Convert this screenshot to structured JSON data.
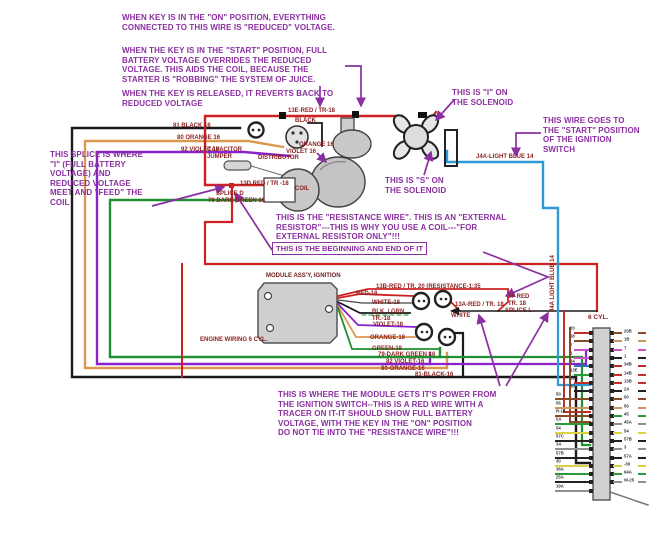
{
  "annotations": {
    "key_on": [
      "WHEN KEY IS IN THE \"ON\" POSITION, EVERYTHING",
      "CONNECTED TO THIS WIRE IS \"REDUCED\" VOLTAGE."
    ],
    "key_start": [
      "WHEN THE KEY IS IN THE \"START\" POSITION, FULL",
      "BATTERY VOLTAGE OVERRIDES THE REDUCED",
      "VOLTAGE. THIS AIDS THE COIL, BECAUSE THE",
      "STARTER IS \"ROBBING\" THE SYSTEM OF JUICE."
    ],
    "key_released": [
      "WHEN THE KEY IS RELEASED, IT REVERTS BACK TO",
      "REDUCED VOLTAGE"
    ],
    "splice_note": [
      "THIS SPLICE IS WHERE",
      "\"I\" (FULL BATTERY",
      "VOLTAGE) AND",
      "REDUCED VOLTAGE",
      "MEET AND \"FEED\" THE",
      "COIL"
    ],
    "i_solenoid": [
      "THIS IS \"I\" ON",
      "THE SOLENOID"
    ],
    "start_wire": [
      "THIS WIRE GOES TO",
      "THE \"START\" POSIITION",
      "OF THE IGNITION",
      "SWITCH"
    ],
    "s_solenoid": [
      "THIS IS \"S\" ON",
      "THE SOLENOID"
    ],
    "resistance_note": [
      "THIS IS THE \"RESISTANCE WIRE\". THIS IS AN \"EXTERNAL",
      "RESISTOR\"---THIS IS WHY YOU USE A COIL---\"FOR",
      "EXTERNAL RESISTOR ONLY\"!!!"
    ],
    "begin_end": "THIS IS THE BEGINNING AND END OF IT",
    "module_power_note": [
      "THIS IS WHERE THE MODULE GETS IT'S POWER FROM",
      "THE IGNITION SWITCH--THIS IS A RED WIRE WITH A",
      "TRACER ON IT-IT SHOULD SHOW FULL BATTERY",
      "VOLTAGE, WITH THE KEY IN THE \"ON\" POSITION",
      "DO NOT TIE INTO THE \"RESISTANCE WIRE\"!!!"
    ]
  },
  "wire_labels": {
    "w81": "81 BLACK 16",
    "w80": "80 ORANGE 16",
    "w92": "92 VIOLET 16",
    "capacitor": [
      "CAPACITOR",
      "JUMPER"
    ],
    "w13d": "13D RED / TR -18",
    "splice_d": "SPLICE D",
    "w79": "79 DARK GREEN 16",
    "w13e": "13E-RED / TR-18",
    "black": "BLACK",
    "orange16": "ORANGE 16",
    "violet16": "VIOLET 16",
    "distributor": "DISTRIBUTOR",
    "coil": "COIL",
    "j4a": "J4A-LIGHT BLUE 14",
    "j4a_vertical": "J4A LIGHT BLUE 14",
    "module": "MODULE ASS'Y, IGNITION",
    "engine": "ENGINE WIRING 6 CYL.",
    "w13b": "13B-RED / TR. 20 (RESISTANCE-1:35",
    "red18": "RED-18",
    "white18": "WHITE-18",
    "blkgrn": [
      "BLK. / GRN",
      "TR.-18"
    ],
    "violet18": "VIOLET-18",
    "orange18": "ORANGE-18",
    "green18": "GREEN-18",
    "w79b": "79-DARK GREEN 16",
    "w82b": "82 VIOLET-16",
    "w80b": "80-ORANGE-16",
    "w81b": "81-BLACK-16",
    "w13a": "13A-RED / TR. 18",
    "white": "WHITE",
    "w3f": [
      "3F RED",
      "TR. 18"
    ],
    "splice_l": "SPLICE L"
  },
  "connector": {
    "title": "6 CYL.",
    "rows": [
      {
        "l": "20",
        "r": "20B",
        "lc": "#c03028",
        "rc": "#8a4a28"
      },
      {
        "l": "18",
        "r": "1B",
        "lc": "#8a4a28",
        "rc": "#c89a62"
      },
      {
        "l": "7",
        "r": "7",
        "lc": "#d050c8",
        "rc": "#d050c8"
      },
      {
        "l": "1",
        "r": "1",
        "lc": "#d050c8",
        "rc": "#222222"
      },
      {
        "l": "34",
        "r": "34B",
        "lc": "#3070c0",
        "rc": "#c03028"
      },
      {
        "l": "13E",
        "r": "14B",
        "lc": "#2a9a3a",
        "rc": "#c03028"
      },
      {
        "l": "13C",
        "r": "13B",
        "lc": "#c03028",
        "rc": "#c03028"
      },
      {
        "l": "10",
        "r": "2A",
        "lc": "#222222",
        "rc": "#222222"
      },
      {
        "l": "50",
        "r": "50",
        "lc": "#8a4a28",
        "rc": "#8a4a28"
      },
      {
        "l": "56",
        "r": "56",
        "lc": "#c89a62",
        "rc": "#c89a62"
      },
      {
        "l": "R-14",
        "r": "45",
        "lc": "#8a4a28",
        "rc": "#2a9a3a"
      },
      {
        "l": "5A",
        "r": "45A",
        "lc": "#2a9a3a",
        "rc": "#909090"
      },
      {
        "l": "54",
        "r": "54",
        "lc": "#ddd23f",
        "rc": "#ddd23f"
      },
      {
        "l": "57C",
        "r": "57B",
        "lc": "#222222",
        "rc": "#222222"
      },
      {
        "l": "3A",
        "r": "3",
        "lc": "#909090",
        "rc": "#909090"
      },
      {
        "l": "57B",
        "r": "57A",
        "lc": "#222222",
        "rc": "#222222"
      },
      {
        "l": "30",
        "r": "-30",
        "lc": "#ddd23f",
        "rc": "#ddd23f"
      },
      {
        "l": "36A",
        "r": "94A",
        "lc": "#2a9a3a",
        "rc": "#2a9a3a"
      },
      {
        "l": "25A",
        "r": "W-25",
        "lc": "#222222",
        "rc": "#909090"
      },
      {
        "l": "19A",
        "r": "",
        "lc": "#909090",
        "rc": ""
      }
    ]
  },
  "colors": {
    "annotation_purple": "#8b2fa0",
    "label_dark_red": "#8b1f1f",
    "wire_red": "#cc2222",
    "wire_black": "#1a1a1a",
    "wire_orange": "#dd9850",
    "wire_violet": "#8822cc",
    "wire_green": "#1f9132",
    "wire_light_blue": "#2e9bd6"
  }
}
